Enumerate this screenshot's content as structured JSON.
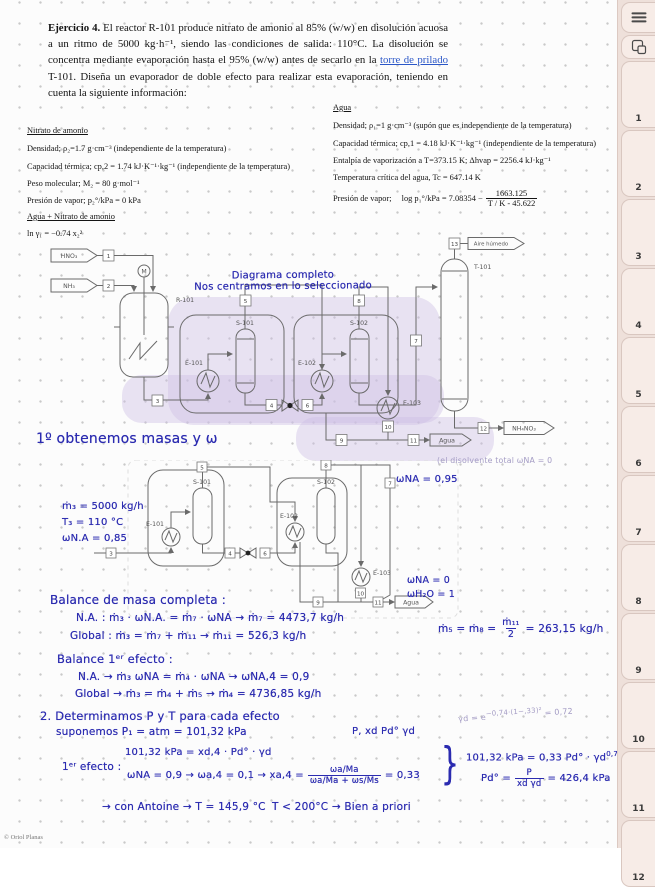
{
  "colors": {
    "handwriting_blue": "#2b2bb0",
    "highlight_lavender": "#cdbfe5",
    "sidebar_bg": "#eee0da",
    "link_blue": "#2b57c8"
  },
  "sidebar": {
    "tabs": [
      "1",
      "2",
      "3",
      "4",
      "5",
      "6",
      "7",
      "8",
      "9",
      "10",
      "11",
      "12"
    ]
  },
  "footer": {
    "copyright": "© Oriol Planas"
  },
  "exercise": {
    "title": "Ejercicio 4.",
    "text1": " El reactor R-101 produce nitrato de amonio al 85% (w/w) en disolución acuosa a un ritmo de 5000 kg·h⁻¹, siendo las condiciones de salida: 110°C. La disolución se concentra mediante evaporación hasta el 95% (w/w) antes de secarlo en la ",
    "link": "torre de prilado",
    "text2": " T-101. Diseña un evaporador de doble efecto para realizar esta evaporación, teniendo en cuenta la siguiente información:"
  },
  "nitrato": {
    "heading": "Nitrato de amonio",
    "l1": "Densidad; ρ₂=1.7 g·cm⁻³ (independiente de la temperatura)",
    "l2": "Capacidad térmica; cp,2 = 1.74 kJ·K⁻¹·kg⁻¹ (independiente de la temperatura)",
    "l3": "Peso molecular; M₂ = 80 g·mol⁻¹",
    "l4": "Presión de vapor;    p₂°/kPa = 0 kPa",
    "heading2": "Agua + Nitrato de amonio",
    "l5": "ln γ₁ = −0.74 x₂²"
  },
  "agua": {
    "heading": "Agua",
    "l1": "Densidad; ρ₁=1 g·cm⁻³ (supón que es independiente de la temperatura)",
    "l2": "Capacidad térmica; cp,1 = 4.18 kJ·K⁻¹·kg⁻¹ (independiente de la temperatura)",
    "l3": "Entalpía de vaporización a T=373.15 K; Δhvap = 2256.4 kJ·kg⁻¹",
    "l4": "Temperatura crítica del agua, Tc = 647.14 K",
    "pv_label": "Presión de vapor;",
    "pv_pre": "log p₁°/kPa = 7.08354 −",
    "pv_num": "1663.125",
    "pv_den": "T / K - 45.622"
  },
  "diagram1": {
    "caption1": "Diagrama completo",
    "caption2": "Nos centramos en lo seleccionado",
    "labels": {
      "hno3": "HNO₃",
      "nh3": "NH₃",
      "m": "M",
      "r101": "R-101",
      "e101": "E-101",
      "s101": "S-101",
      "e102": "E-102",
      "s102": "S-102",
      "e103": "E-103",
      "t101": "T-101",
      "aire": "Aire húmedo",
      "nh4no3": "NH₄NO₃",
      "agua": "Agua"
    },
    "tags": [
      "1",
      "2",
      "3",
      "4",
      "5",
      "6",
      "7",
      "8",
      "9",
      "10",
      "11",
      "12",
      "13"
    ]
  },
  "step1": {
    "title": "1º obtenemos masas  y  ω"
  },
  "diagram2": {
    "labels": {
      "e101": "E-101",
      "s101": "S-101",
      "e102": "E-102",
      "s102": "S-102",
      "e103": "E-103",
      "agua": "Agua"
    },
    "tags": [
      "3",
      "4",
      "5",
      "6",
      "7",
      "8",
      "9",
      "10",
      "11"
    ],
    "ann": {
      "m3": "ṁ₃ = 5000 kg/h",
      "t3": "T₃ = 110 °C",
      "wna": "ωN.A = 0,85",
      "w95": "ωNA = 0,95",
      "note": "(el disolvente total   ωNA = 0",
      "w0": "ωNA = 0",
      "w1": "ωH₂O = 1"
    }
  },
  "balance": {
    "heading": "Balance de masa completa :",
    "l1": "N.A. :   ṁ₃ · ωN.A. = ṁ₇ · ωNA   →   ṁ₇ = 4473,7 kg/h",
    "l2": "Global :  ṁ₃ = ṁ₇ + ṁ₁₁   →  ṁ₁₁ = 526,3 kg/h",
    "side_pre": "ṁ₅ = ṁ₈ =",
    "side_num": "ṁ₁₁",
    "side_den": "2",
    "side_post": "= 263,15 kg/h",
    "heading2": "Balance 1ᵉʳ efecto :",
    "l3": "N.A. →  ṁ₃ ωNA = ṁ₄ · ωNA  →  ωNA,4 = 0,9",
    "l4": "Global →  ṁ₃ = ṁ₄ + ṁ₅  → ṁ₄ = 4736,85 kg/h"
  },
  "step2": {
    "heading": "2. Determinamos  P y T  para cada efecto",
    "sup": "suponemos  P₁ = atm = 101,32 kPa",
    "note_right": "P,  xd Pd°  γd",
    "gn_pre": "γd = e",
    "gn_exp": "−0,74·(1−,33)²",
    "gn_post": "= 0,72",
    "ef": "1ᵉʳ efecto :",
    "e1": "101,32 kPa = xd,4 · Pd° · γd",
    "e2_pre": "ωNA = 0,9 → ωa,4 = 0,1 → xa,4 =",
    "e2_num": "ωa/Ma",
    "e2_den": "ωa/Ma + ωs/Ms",
    "e2_post": "= 0,33",
    "brace": "}",
    "r1": "101,32 kPa = 0,33 Pd° · γd",
    "r1_sup": "0,72",
    "r2_pre": "Pd° =",
    "r2_num": "P",
    "r2_den": "xd γd",
    "r2_post": "= 426,4 kPa",
    "antoine": "→ con Antoine → T = 145,9 °C",
    "tcheck": "T < 200°C →  Bien  a priori"
  }
}
